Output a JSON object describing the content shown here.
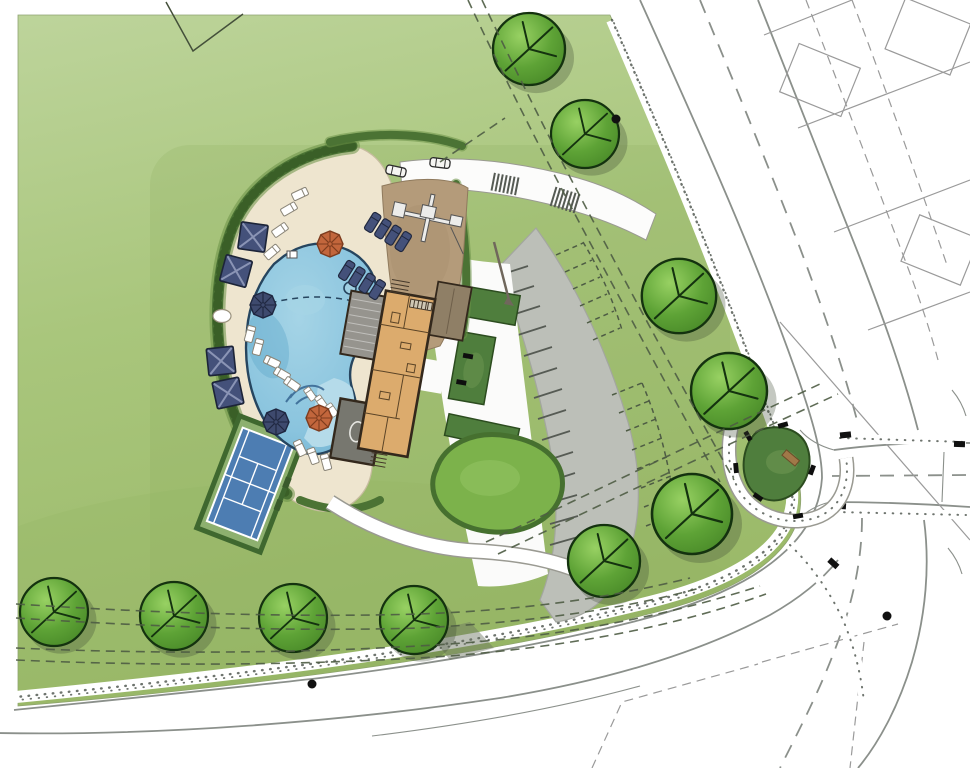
{
  "scene": {
    "type": "site-plan-rendering",
    "description": "Color rendered landscape site plan of a community amenity center on a corner parcel"
  },
  "colors": {
    "page_bg": "#ffffff",
    "grass_light": "#bdd49b",
    "grass": "#a9c67c",
    "grass_dark": "#9ab968",
    "lawn_bright": "#7cb24b",
    "hedge_dark": "#4b7334",
    "shrub_dark": "#4f7e3d",
    "deck_cream": "#eee5cf",
    "deck_edge": "#c7bca0",
    "pool_water": "#8ac4de",
    "pool_water_deep": "#64aacb",
    "pool_ledge": "#b7dcea",
    "pool_outline": "#26455f",
    "playground_sand": "#b49b7a",
    "building_tan": "#dcab6d",
    "building_outline": "#33281c",
    "porch_gray": "#96948e",
    "pavilion_gray": "#77776f",
    "roof_brown": "#8f7f66",
    "parking_gray": "#bcbfb8",
    "road_line": "#8b908b",
    "lot_line": "#9a9a9a",
    "stripe_dark": "#565b54",
    "util_green": "#4e5c44",
    "tree_light": "#98d163",
    "tree_mid": "#5ea336",
    "tree_dark": "#478727",
    "tree_outline": "#14320f",
    "umbrella_orange": "#c2663c",
    "umbrella_navy": "#3e4a6e",
    "cabana_navy": "#44517a",
    "court_blue": "#4d7db2",
    "court_apron": "#8db06f",
    "sidewalk_dot": "#3d463d"
  },
  "features": {
    "pool": {
      "label": "free-form swimming pool",
      "spa_jets": 3,
      "in_pool_loungers": 4
    },
    "tennis_court": {
      "label": "tennis court",
      "count": 1
    },
    "playground": {
      "label": "playground with play structure"
    },
    "clubhouse": {
      "label": "clubhouse floor plan with covered porches and pavilion"
    },
    "parking": {
      "label": "curved parking lot",
      "solid_stalls": 15,
      "future_dashed_stalls": 14
    },
    "cabanas": {
      "label": "square shade cabanas",
      "count": 4
    },
    "umbrellas": {
      "orange": 2,
      "navy": 2
    },
    "trees": {
      "count": 10
    },
    "corner_plaza": {
      "label": "corner garden plaza with winding path",
      "benches": 6
    },
    "cars": {
      "count": 2
    },
    "crosswalks": {
      "count": 2
    },
    "dot_markers": {
      "count": 3
    }
  }
}
